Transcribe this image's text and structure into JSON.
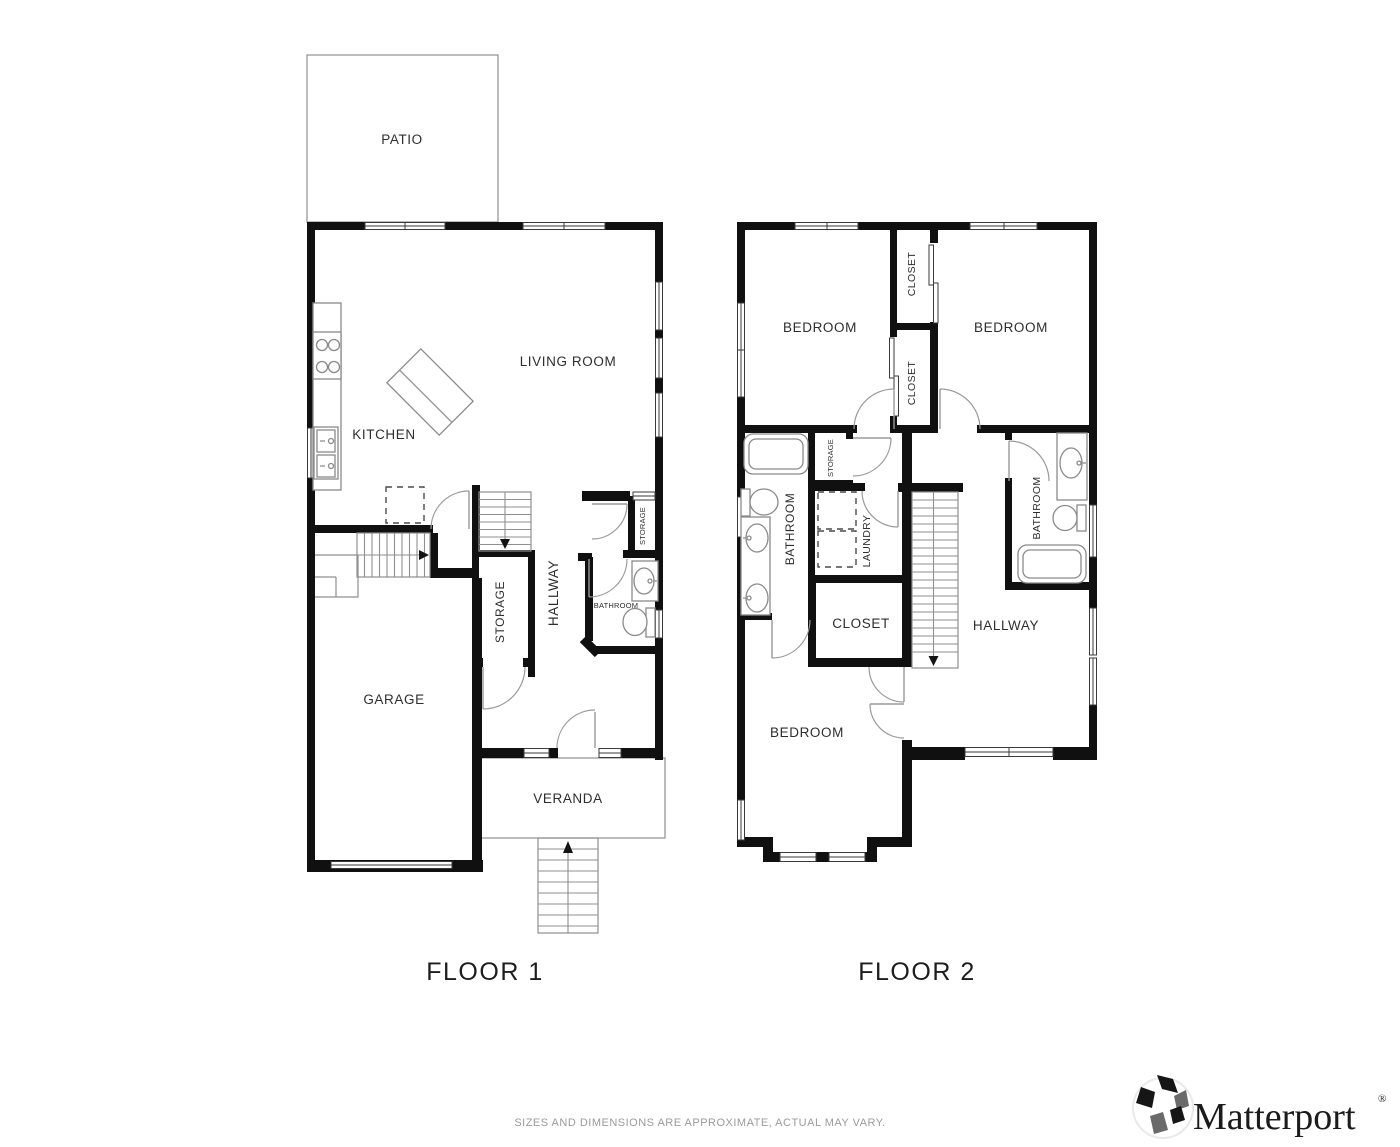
{
  "floor1": {
    "title": "FLOOR 1",
    "rooms": {
      "patio": "PATIO",
      "living_room": "LIVING ROOM",
      "kitchen": "KITCHEN",
      "storage": "STORAGE",
      "hallway": "HALLWAY",
      "storage_small": "STORAGE",
      "bathroom": "BATHROOM",
      "garage": "GARAGE",
      "veranda": "VERANDA"
    }
  },
  "floor2": {
    "title": "FLOOR 2",
    "rooms": {
      "bedroom_left": "BEDROOM",
      "bedroom_right": "BEDROOM",
      "closet_upper": "CLOSET",
      "closet_lower": "CLOSET",
      "bathroom_left": "BATHROOM",
      "storage": "STORAGE",
      "laundry": "LAUNDRY",
      "closet": "CLOSET",
      "hallway": "HALLWAY",
      "bathroom_right": "BATHROOM",
      "bedroom_bottom": "BEDROOM"
    }
  },
  "footer": {
    "disclaimer": "SIZES AND DIMENSIONS ARE APPROXIMATE, ACTUAL MAY VARY."
  },
  "branding": {
    "name": "Matterport",
    "registered": "®"
  },
  "colors": {
    "wall": "#101010",
    "thin_line": "#8f8f8f",
    "window_line": "#3a3a3a",
    "label": "#2e2e2e",
    "disclaimer": "#9b9b9b",
    "background": "#ffffff"
  }
}
